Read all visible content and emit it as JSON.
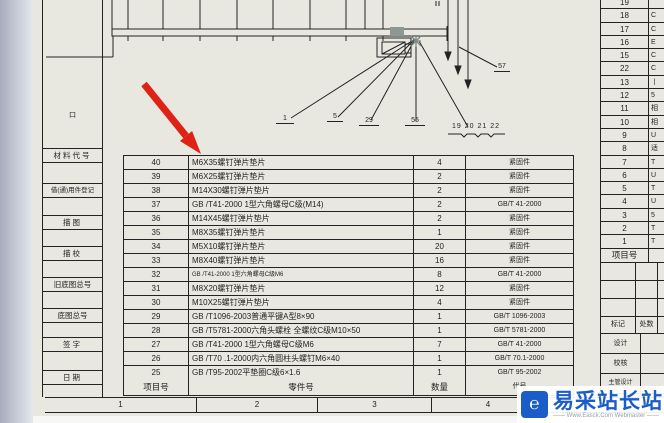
{
  "colors": {
    "paper": "#e8e8e0",
    "line": "#232323",
    "annotation_red": "#de2316",
    "watermark_blue": "#1a5dc8",
    "selection_gray": "#8e9794"
  },
  "left_panel": {
    "mark": "口",
    "labels": [
      "材料代号",
      "借(通)用件登记",
      "描图",
      "描校",
      "旧底图总号",
      "底图总号",
      "签字",
      "日期"
    ]
  },
  "main_table": {
    "headers": {
      "item": "项目号",
      "part": "零件号",
      "qty": "数量",
      "code": "代号"
    },
    "rows": [
      {
        "item": "40",
        "name": "M6X35螺钉弹片垫片",
        "qty": "4",
        "code": "紧固件"
      },
      {
        "item": "39",
        "name": "M6X25螺钉弹片垫片",
        "qty": "2",
        "code": "紧固件"
      },
      {
        "item": "38",
        "name": "M14X30螺钉弹片垫片",
        "qty": "2",
        "code": "紧固件"
      },
      {
        "item": "37",
        "name": "GB /T41-2000 1型六角螺母C级(M14)",
        "qty": "2",
        "code": "GB/T 41-2000"
      },
      {
        "item": "36",
        "name": "M14X45螺钉弹片垫片",
        "qty": "2",
        "code": "紧固件"
      },
      {
        "item": "35",
        "name": "M8X35螺钉弹片垫片",
        "qty": "1",
        "code": "紧固件"
      },
      {
        "item": "34",
        "name": "M5X10螺钉弹片垫片",
        "qty": "20",
        "code": "紧固件"
      },
      {
        "item": "33",
        "name": "M8X40螺钉弹片垫片",
        "qty": "16",
        "code": "紧固件"
      },
      {
        "item": "32",
        "name": "GB /T41-2000 1型六角螺母C级M6",
        "qty": "8",
        "code": "GB/T 41-2000",
        "compact": true
      },
      {
        "item": "31",
        "name": "M8X20螺钉弹片垫片",
        "qty": "12",
        "code": "紧固件"
      },
      {
        "item": "30",
        "name": "M10X25螺钉弹片垫片",
        "qty": "4",
        "code": "紧固件"
      },
      {
        "item": "29",
        "name": "GB /T1096-2003普通平键A型8×90",
        "qty": "1",
        "code": "GB/T 1096-2003"
      },
      {
        "item": "28",
        "name": "GB /T5781-2000六角头螺栓 全螺纹C级M10×50",
        "qty": "1",
        "code": "GB/T 5781-2000"
      },
      {
        "item": "27",
        "name": "GB /T41-2000 1型六角螺母C级M6",
        "qty": "7",
        "code": "GB/T 41-2000"
      },
      {
        "item": "26",
        "name": "GB /T70 .1-2000内六角圆柱头螺钉M6×40",
        "qty": "1",
        "code": "GB/T 70.1-2000"
      },
      {
        "item": "25",
        "name": "GB /T95-2002平垫圈C级6×1.6",
        "qty": "1",
        "code": "GB/T 95-2002"
      }
    ]
  },
  "right_table": {
    "header": "项目号",
    "rows": [
      {
        "item": "19",
        "frag": ""
      },
      {
        "item": "18",
        "frag": "C"
      },
      {
        "item": "17",
        "frag": "C"
      },
      {
        "item": "16",
        "frag": "E"
      },
      {
        "item": "15",
        "frag": "C"
      },
      {
        "item": "22",
        "frag": "C"
      },
      {
        "item": "13",
        "frag": "丨"
      },
      {
        "item": "12",
        "frag": "5"
      },
      {
        "item": "11",
        "frag": "相"
      },
      {
        "item": "10",
        "frag": "相"
      },
      {
        "item": "9",
        "frag": "U"
      },
      {
        "item": "8",
        "frag": "适"
      },
      {
        "item": "7",
        "frag": "T"
      },
      {
        "item": "6",
        "frag": "U"
      },
      {
        "item": "5",
        "frag": "T"
      },
      {
        "item": "4",
        "frag": "U"
      },
      {
        "item": "3",
        "frag": "5"
      },
      {
        "item": "2",
        "frag": "T"
      },
      {
        "item": "1",
        "frag": "T"
      }
    ]
  },
  "title_block": {
    "mark": "标记",
    "count": "处数",
    "design": "设计",
    "check": "校核",
    "chief_design": "主管设计"
  },
  "border_zones": [
    "1",
    "2",
    "3",
    "4"
  ],
  "balloons": {
    "b1": "1",
    "b2": "5",
    "b3": "29",
    "b4": "55",
    "group": "19 20 21 22",
    "b57": "57"
  },
  "watermark": {
    "logo_glyph": "℮",
    "title": "易采站长站",
    "subtitle": "—— Www.Easck.Com Webmaster ——"
  }
}
